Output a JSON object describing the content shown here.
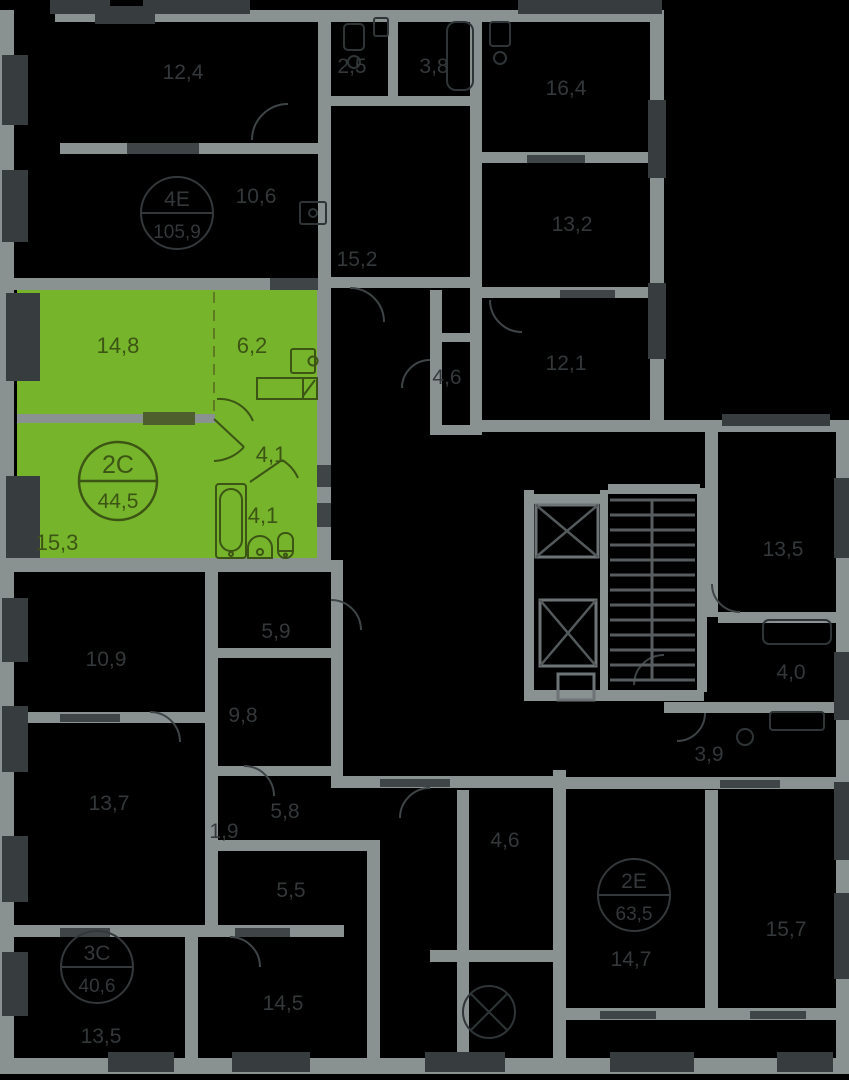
{
  "selected_unit": {
    "type": "2С",
    "total_area": "44,5",
    "room_areas": [
      "14,8",
      "6,2",
      "4,1",
      "4,1",
      "15,3"
    ]
  },
  "other_units": [
    {
      "type": "4Е",
      "area": "105,9"
    },
    {
      "type": "3С",
      "area": "40,6"
    },
    {
      "type": "2Е",
      "area": "63,5"
    }
  ],
  "dim_labels": [
    "12,4",
    "10,6",
    "2,5",
    "3,8",
    "16,4",
    "13,2",
    "15,2",
    "12,1",
    "4,6",
    "13,5",
    "4,0",
    "3,9",
    "10,9",
    "5,9",
    "9,8",
    "13,7",
    "5,8",
    "1,9",
    "5,5",
    "14,5",
    "13,5",
    "14,7",
    "15,7",
    "4,6"
  ],
  "colors": {
    "background": "#000000",
    "walls": "#8A9191",
    "windows": "#373D3F",
    "highlight": "#75B42B",
    "highlight_text": "#3C5414",
    "dim_text": "#34383A"
  }
}
